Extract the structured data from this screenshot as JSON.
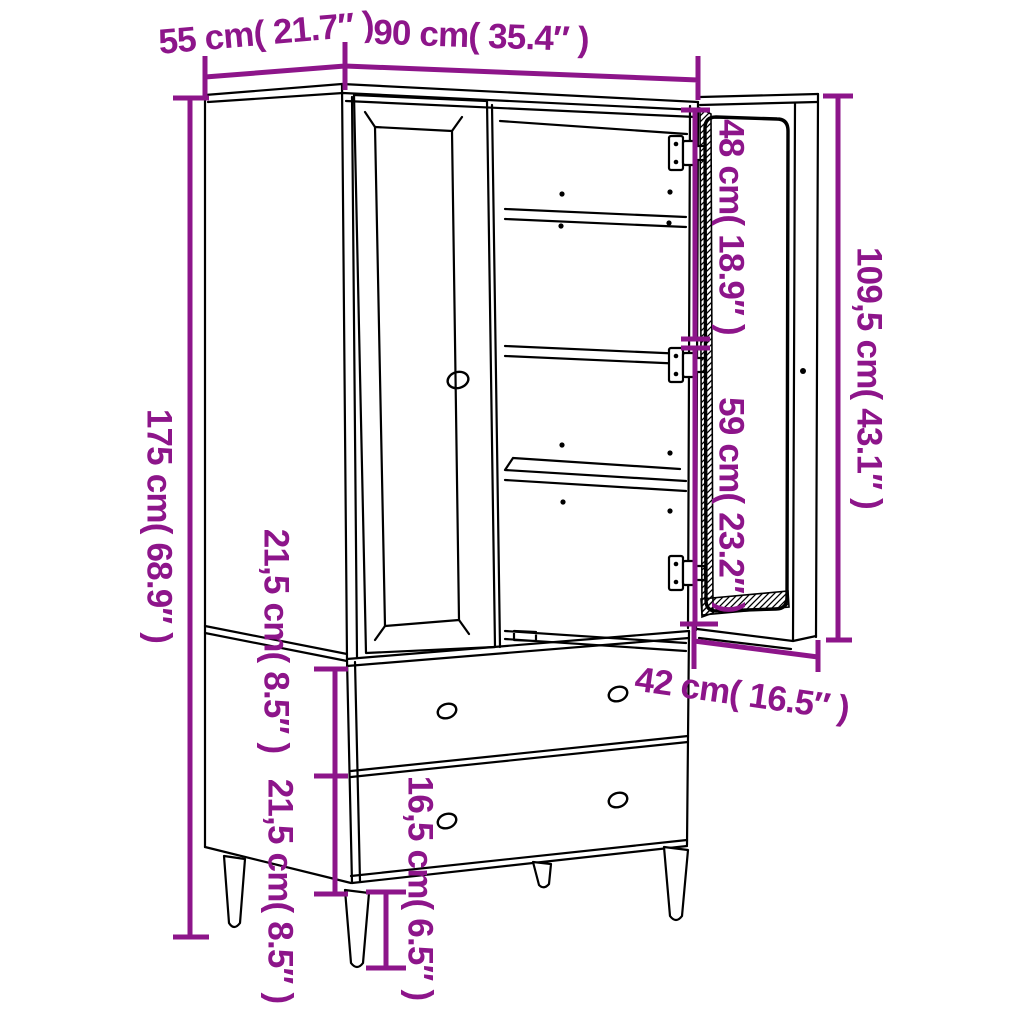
{
  "diagram": {
    "type": "furniture-dimension-diagram",
    "colors": {
      "dimension": "#8D158A",
      "line": "#000000",
      "background": "#FFFFFF"
    },
    "labels": {
      "top_depth": "55 cm( 21.7″ )",
      "top_width": "90 cm( 35.4″ )",
      "total_height": "175 cm( 68.9″ )",
      "upper_compartment_height": "48 cm( 18.9″ )",
      "lower_compartment_height": "59 cm( 23.2″ )",
      "door_height": "109,5 cm( 43.1″ )",
      "upper_drawer_height": "21,5 cm( 8.5″ )",
      "lower_drawer_height": "21,5 cm( 8.5″ )",
      "leg_height": "16,5 cm( 6.5″ )",
      "drawer_depth": "42 cm( 16.5″ )"
    }
  }
}
